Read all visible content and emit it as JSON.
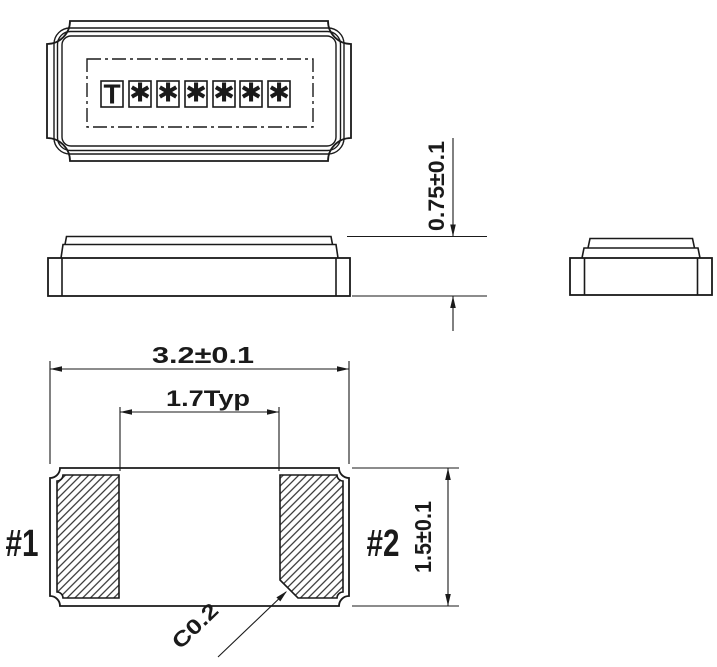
{
  "colors": {
    "line": "#1a1a1a",
    "background": "#ffffff"
  },
  "views": {
    "top": {
      "marking_chars": [
        "T",
        "✱",
        "✱",
        "✱",
        "✱",
        "✱",
        "✱"
      ]
    }
  },
  "dimensions": {
    "height": "0.75±0.1",
    "length": "3.2±0.1",
    "pad_pitch": "1.7Typ",
    "width": "1.5±0.1",
    "chamfer": "C0.2"
  },
  "pads": {
    "pad1_label": "#1",
    "pad2_label": "#2"
  }
}
